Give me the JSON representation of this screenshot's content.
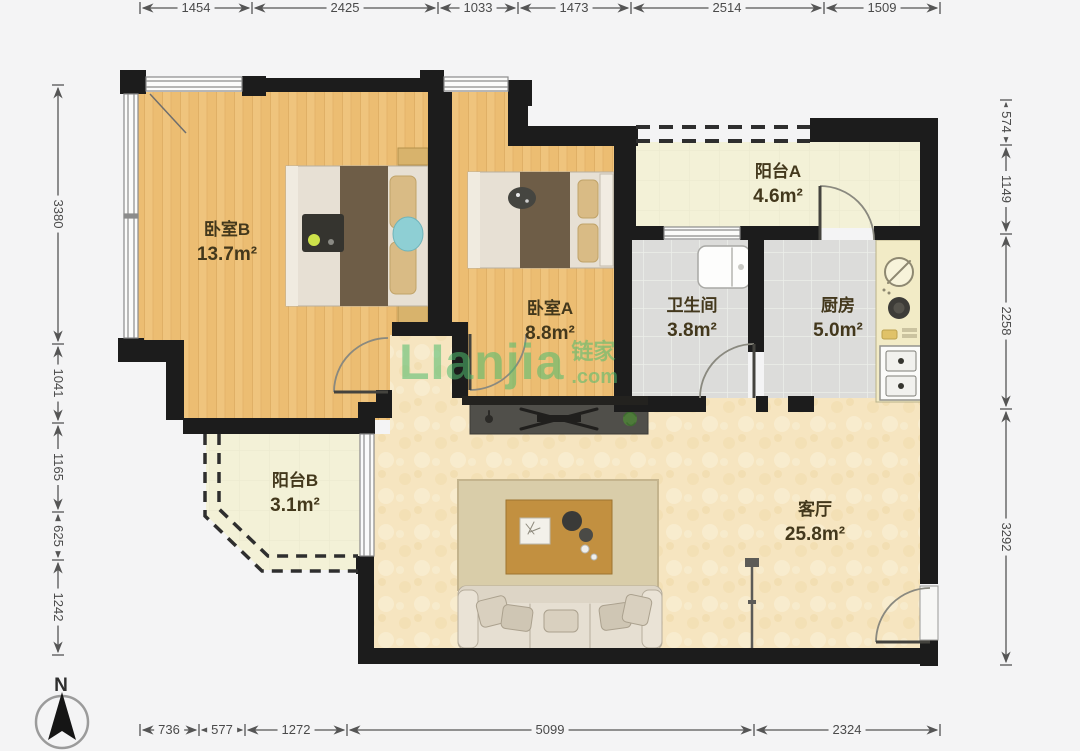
{
  "page": {
    "bg": "#f4f4f5"
  },
  "compass": {
    "label": "N"
  },
  "watermark": {
    "brand": "LIanjia",
    "brand_cn": "链家",
    "suffix": ".com",
    "color": "#4fbc6e"
  },
  "rooms": [
    {
      "id": "bedroom-b",
      "name": "卧室B",
      "area": "13.7m²"
    },
    {
      "id": "bedroom-a",
      "name": "卧室A",
      "area": "8.8m²"
    },
    {
      "id": "balcony-a",
      "name": "阳台A",
      "area": "4.6m²"
    },
    {
      "id": "bathroom",
      "name": "卫生间",
      "area": "3.8m²"
    },
    {
      "id": "kitchen",
      "name": "厨房",
      "area": "5.0m²"
    },
    {
      "id": "balcony-b",
      "name": "阳台B",
      "area": "3.1m²"
    },
    {
      "id": "living-room",
      "name": "客厅",
      "area": "25.8m²"
    }
  ],
  "dimensions": {
    "top": [
      "1454",
      "2425",
      "1033",
      "1473",
      "2514",
      "1509"
    ],
    "left": [
      "3380",
      "1041",
      "1165",
      "625",
      "1242"
    ],
    "right": [
      "574",
      "1149",
      "2258",
      "3292"
    ],
    "bottom": [
      "736",
      "577",
      "1272",
      "5099",
      "2324"
    ]
  },
  "palette": {
    "wall": "#1c1c1c",
    "wood": "#ecbd72",
    "tile": "#dcdcda",
    "living": "#f6e5c0",
    "balcony": "#f3f1d7"
  }
}
